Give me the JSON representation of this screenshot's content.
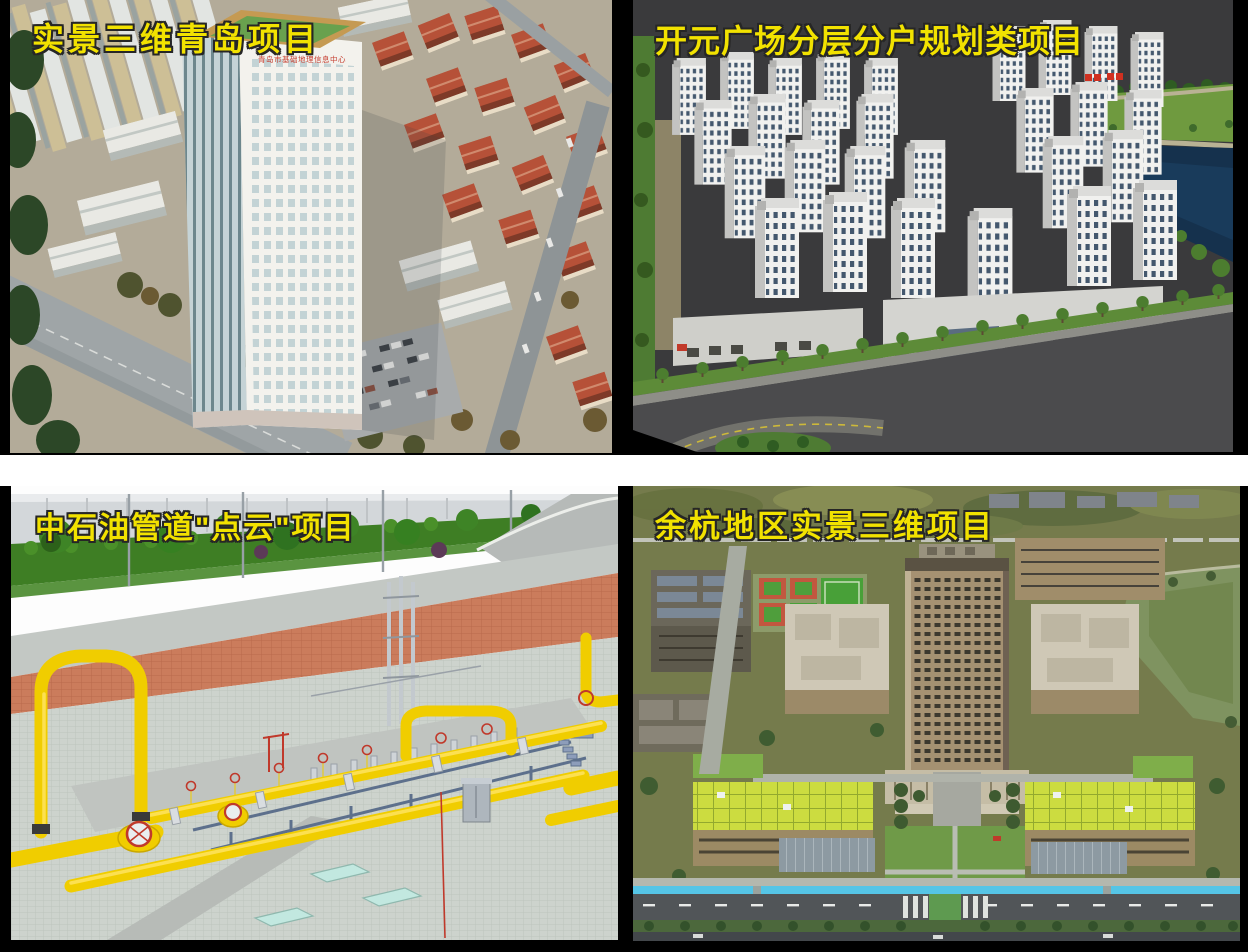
{
  "slide": {
    "background_color": "#000000",
    "divider_color": "#ffffff",
    "caption_color": "#f2e200"
  },
  "projects": [
    {
      "id": "qingdao",
      "title": "实景三维青岛项目",
      "building_sign": "青岛市基础地理信息中心"
    },
    {
      "id": "kaiyuan-plaza",
      "title": "开元广场分层分户规划类项目"
    },
    {
      "id": "pipeline-pointcloud",
      "title": "中石油管道\"点云\"项目"
    },
    {
      "id": "yuhang",
      "title": "余杭地区实景三维项目"
    }
  ]
}
